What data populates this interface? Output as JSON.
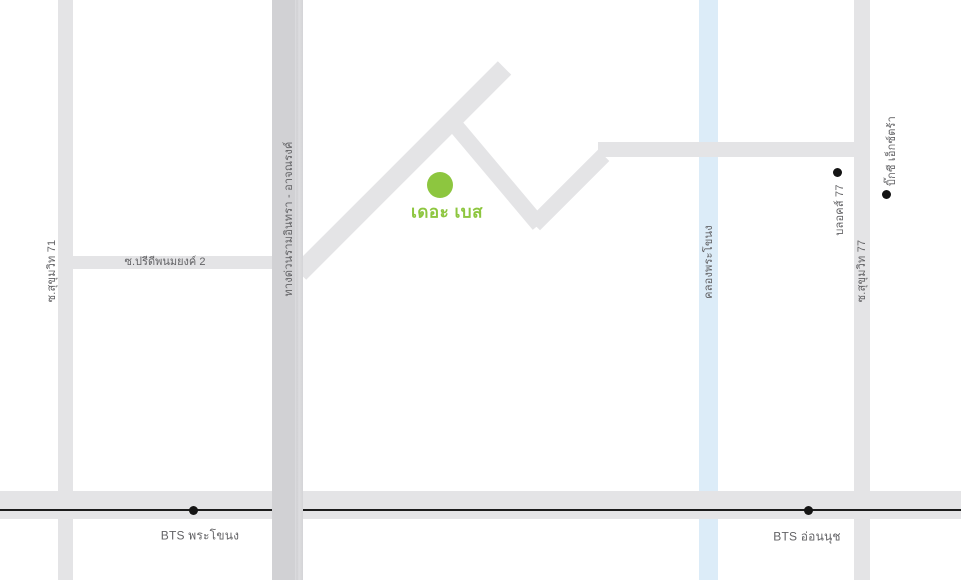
{
  "map": {
    "marker": {
      "label": "เดอะ เบส"
    },
    "roads": {
      "sukhumvit71": {
        "label": "ซ.สุขุมวิท 71"
      },
      "pridi2": {
        "label": "ซ.ปรีดีพนมยงค์ 2"
      },
      "expressway": {
        "label": "ทางด่วนรามอินทรา - อาจณรงค์"
      },
      "canal": {
        "label": "คลองพระโขนง"
      },
      "sukhumvit77": {
        "label": "ซ.สุขุมวิท 77"
      }
    },
    "places": {
      "blocs77": {
        "label": "บลอคส์ 77"
      },
      "bigc_extra": {
        "label": "บิ๊กซี เอ็กซ์ตร้า"
      }
    },
    "stations": {
      "phra_khanong": {
        "label": "BTS พระโขนง"
      },
      "on_nut": {
        "label": "BTS อ่อนนุช"
      }
    },
    "colors": {
      "road": "#e4e4e6",
      "expressway": "#d1d1d4",
      "canal": "#dcecf8",
      "accent_green": "#8dc63f",
      "label_gray": "#636366",
      "rail_black": "#1c1c1c"
    }
  }
}
